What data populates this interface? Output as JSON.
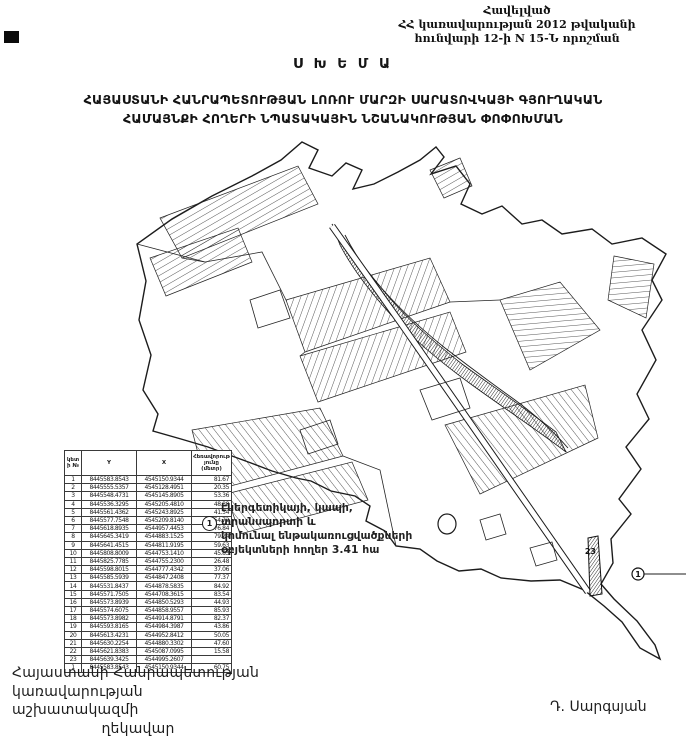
{
  "document": {
    "appendix": {
      "line1": "Հավելված",
      "line2": "ՀՀ կառավարության 2012 թվականի",
      "line3": "հունվարի 12-ի N 15-Ն որոշման"
    },
    "title": "Ս Խ Ե Մ Ա",
    "heading_line1": "ՀԱՅԱՍՏԱՆԻ ՀԱՆՐԱՊԵՏՈՒԹՅԱՆ ԼՈՌՈՒ ՄԱՐԶԻ ՍԱՐԱՏՈՎԿԱՅԻ ԳՅՈՒՂԱԿԱՆ",
    "heading_line2": "ՀԱՄԱՅՆՔԻ ՀՈՂԵՐԻ ՆՊԱՏԱԿԱՅԻՆ ՆՇԱՆԱԿՈՒԹՅԱՆ ՓՈՓՈԽՄԱՆ",
    "legend": {
      "symbol": "1",
      "line1": "էներգետիկայի, կապի, տրանսպորտի և",
      "line2": "կոմունալ ենթակառուցվածքների",
      "line3": "օբյեկտների հողեր",
      "area_value": "3.41 հա"
    },
    "map_labels": {
      "point_label": "23",
      "parcel_symbol": "1"
    },
    "signature": {
      "left_line1": "Հայաստանի Հանրապետության",
      "left_line2": "կառավարության աշխատակազմի",
      "left_line3": "ղեկավար",
      "right": "Դ. Սարգսյան"
    }
  },
  "table": {
    "headers": [
      "կետի №",
      "Y",
      "X",
      "Հեռավորությունը (մետր)"
    ],
    "rows": [
      [
        "1",
        "8445583.8543",
        "4545150.9344",
        "81.67"
      ],
      [
        "2",
        "8445555.5357",
        "4545128.4951",
        "20.35"
      ],
      [
        "3",
        "8445548.4731",
        "4545145.8905",
        "53.36"
      ],
      [
        "4",
        "8445536.3295",
        "4545205.4810",
        "48.88"
      ],
      [
        "5",
        "8445561.4362",
        "4545243.8925",
        "41.54"
      ],
      [
        "6",
        "8445577.7548",
        "4545209.8140",
        "54.72"
      ],
      [
        "7",
        "8445618.8935",
        "4544957.4453",
        "76.84"
      ],
      [
        "8",
        "8445645.3419",
        "4544883.1525",
        "79.24"
      ],
      [
        "9",
        "8445641.4515",
        "4544811.9195",
        "59.63"
      ],
      [
        "10",
        "8445808.8009",
        "4544753.1410",
        "45.83"
      ],
      [
        "11",
        "8445825.7785",
        "4544755.2300",
        "26.48"
      ],
      [
        "12",
        "8445598.8015",
        "4544777.4342",
        "37.06"
      ],
      [
        "13",
        "8445585.5939",
        "4544847.2408",
        "77.37"
      ],
      [
        "14",
        "8445531.8437",
        "4544878.5835",
        "84.92"
      ],
      [
        "15",
        "8445571.7505",
        "4544708.3615",
        "83.54"
      ],
      [
        "16",
        "8445573.8939",
        "4544850.5293",
        "44.93"
      ],
      [
        "17",
        "8445574.6075",
        "4544858.9557",
        "85.93"
      ],
      [
        "18",
        "8445573.8982",
        "4544914.8791",
        "82.37"
      ],
      [
        "19",
        "8445593.8165",
        "4544984.3987",
        "43.86"
      ],
      [
        "20",
        "8445613.4231",
        "4544952.8412",
        "50.05"
      ],
      [
        "21",
        "8445630.2254",
        "4544880.3302",
        "47.60"
      ],
      [
        "22",
        "8445621.8383",
        "4545087.0995",
        "15.58"
      ],
      [
        "23",
        "8445639.3425",
        "4544995.2607",
        ""
      ],
      [
        "1",
        "8445583.8543",
        "4545150.9344",
        "60.75"
      ]
    ]
  },
  "colors": {
    "ink": "#151515",
    "paper": "#ffffff"
  }
}
